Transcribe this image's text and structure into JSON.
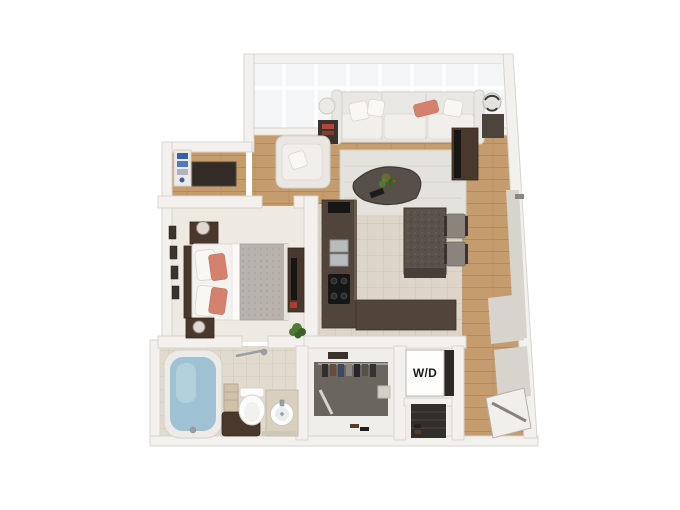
{
  "labels": {
    "washer_dryer": "W/D"
  },
  "colors": {
    "background": "#ffffff",
    "wall": "#f3f1ed",
    "wall_edge": "#d8d4ce",
    "wall_shade": "#d7d3cd",
    "glass": "#f3f5f6",
    "wood": "#c49c6e",
    "wood_line": "#b28a5c",
    "tile": "#ddd6c8",
    "tile_line": "#ccc4b2",
    "carpet": "#eeeae2",
    "closet_floor": "#6b6560",
    "rug": "#e4e2dd",
    "sofa": "#e9e7e3",
    "accent_coral": "#d4826e",
    "dark_wood": "#4a382c",
    "counter": "#51453b",
    "granite": "#59524a",
    "duvet": "#b7b3ac",
    "water": "#9ec2d3",
    "plant_green": "#4f7a36",
    "tv_black": "#161616",
    "text_dark": "#1c1c1c"
  },
  "floorplan": {
    "view": "3d-top-down-render",
    "rooms": [
      "living-room",
      "bedroom",
      "kitchen",
      "bathroom",
      "walk-in-closet",
      "laundry-closet",
      "entry-hall",
      "desk-nook"
    ],
    "furniture": {
      "living_room": [
        "window-wall",
        "sofa",
        "accent-pillow",
        "armchair",
        "area-rug",
        "coffee-table",
        "flower-centerpiece",
        "side-table-left",
        "table-lamp-left",
        "side-table-right",
        "table-lamp-right",
        "tv-console",
        "tv"
      ],
      "bedroom": [
        "queen-bed",
        "gray-duvet",
        "coral-pillows",
        "headboard",
        "nightstand-top",
        "nightstand-bottom",
        "table-lamps",
        "wall-frames",
        "dresser",
        "plant"
      ],
      "kitchen": [
        "l-shaped-counter",
        "double-sink",
        "cooktop",
        "island",
        "two-stools",
        "appliance"
      ],
      "bathroom": [
        "bathtub",
        "shower-bar",
        "toilet",
        "vanity-sink",
        "storage-bench",
        "towel-stack",
        "bath-mat"
      ],
      "closet": [
        "hanging-rail",
        "hanging-clothes",
        "shoes",
        "storage-bag",
        "shelf"
      ],
      "laundry": [
        "washer-dryer-unit",
        "shoe-shelf-closet"
      ],
      "entry": [
        "entry-door"
      ]
    }
  }
}
